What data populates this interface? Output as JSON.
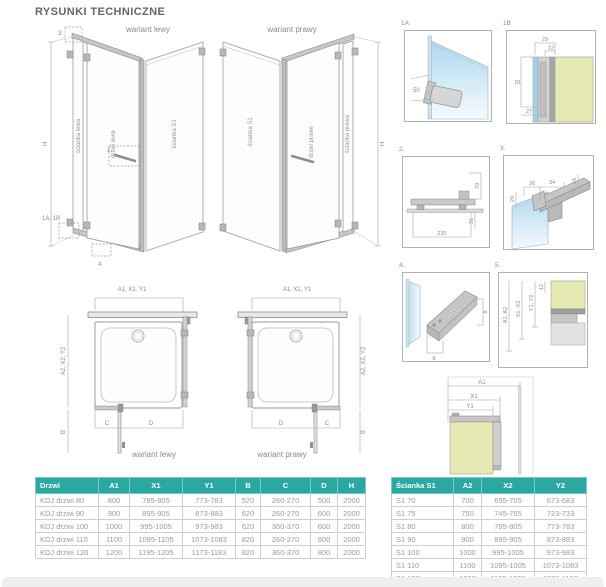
{
  "title": "RYSUNKI TECHNICZNE",
  "iso_left": {
    "label": "wariant lewy",
    "wall_left": "ścianka lewa",
    "door": "drzwi lewe",
    "wall_s1": "ścianka S1",
    "h": "H",
    "callout_3": "3.",
    "callout_2": "2.",
    "callout_1ab": "1A, 1B",
    "callout_4": "4."
  },
  "iso_right": {
    "label": "wariant prawy",
    "wall_s1": "ścianka S1",
    "door": "drzwi prawe",
    "wall_right": "ścianka prawa",
    "h": "H"
  },
  "details": {
    "d1a": {
      "id": "1A",
      "dim_50": "50"
    },
    "d1b": {
      "id": "1B",
      "dim_29": "29",
      "dim_12": "12",
      "dim_81": "81",
      "dim_27": "27"
    },
    "d2": {
      "id": "2.",
      "dim_70": "70",
      "dim_31": "31",
      "dim_230": "230"
    },
    "d3": {
      "id": "3.",
      "dim_26": "26",
      "dim_34": "34",
      "dim_16": "16",
      "dim_20": "20"
    },
    "d4": {
      "id": "4.",
      "dim_8a": "8",
      "dim_8b": "8"
    },
    "d5": {
      "id": "5.",
      "dim_a": "A1, A2",
      "dim_x": "X1, X2",
      "dim_y": "Y1, Y2",
      "dim_12": "12"
    }
  },
  "plans": {
    "left": {
      "label": "wariant lewy",
      "top": "A1, X1, Y1",
      "side": "A2, X2, Y2",
      "b": "B",
      "c": "C",
      "d": "D"
    },
    "right": {
      "label": "wariant prawy",
      "top": "A1, X1, Y1",
      "side": "A2, X2, Y2",
      "b": "B",
      "c": "C",
      "d": "D"
    }
  },
  "corner": {
    "a1": "A1",
    "x1": "X1",
    "y1": "Y1"
  },
  "tables": {
    "doors": {
      "headers": [
        "Drzwi",
        "A1",
        "X1",
        "Y1",
        "B",
        "C",
        "D",
        "H"
      ],
      "rows": [
        [
          "KDJ drzwi 80",
          "800",
          "795-805",
          "773-783",
          "520",
          "260-270",
          "500",
          "2000"
        ],
        [
          "KDJ drzwi 90",
          "900",
          "895-905",
          "873-883",
          "620",
          "260-270",
          "600",
          "2000"
        ],
        [
          "KDJ drzwi 100",
          "1000",
          "995-1005",
          "973-983",
          "620",
          "360-370",
          "600",
          "2000"
        ],
        [
          "KDJ drzwi 110",
          "1100",
          "1095-1105",
          "1073-1083",
          "820",
          "260-270",
          "800",
          "2000"
        ],
        [
          "KDJ drzwi 120",
          "1200",
          "1195-1205",
          "1173-1183",
          "820",
          "360-370",
          "800",
          "2000"
        ]
      ]
    },
    "wall": {
      "headers": [
        "Ścianka S1",
        "A2",
        "X2",
        "Y2"
      ],
      "rows": [
        [
          "S1 70",
          "700",
          "695-705",
          "673-683"
        ],
        [
          "S1 75",
          "750",
          "745-755",
          "723-733"
        ],
        [
          "S1 80",
          "800",
          "795-805",
          "773-783"
        ],
        [
          "S1 90",
          "900",
          "895-905",
          "873-883"
        ],
        [
          "S1 100",
          "1000",
          "995-1005",
          "973-983"
        ],
        [
          "S1 110",
          "1100",
          "1095-1005",
          "1073-1083"
        ],
        [
          "S1 120",
          "1200",
          "1195-1205",
          "1173-1183"
        ]
      ]
    }
  },
  "colors": {
    "accent": "#2BA8A2",
    "wall_fill": "#E6E9B4",
    "glass_fill": "#BFE0F2",
    "line": "#9A9A9A"
  }
}
